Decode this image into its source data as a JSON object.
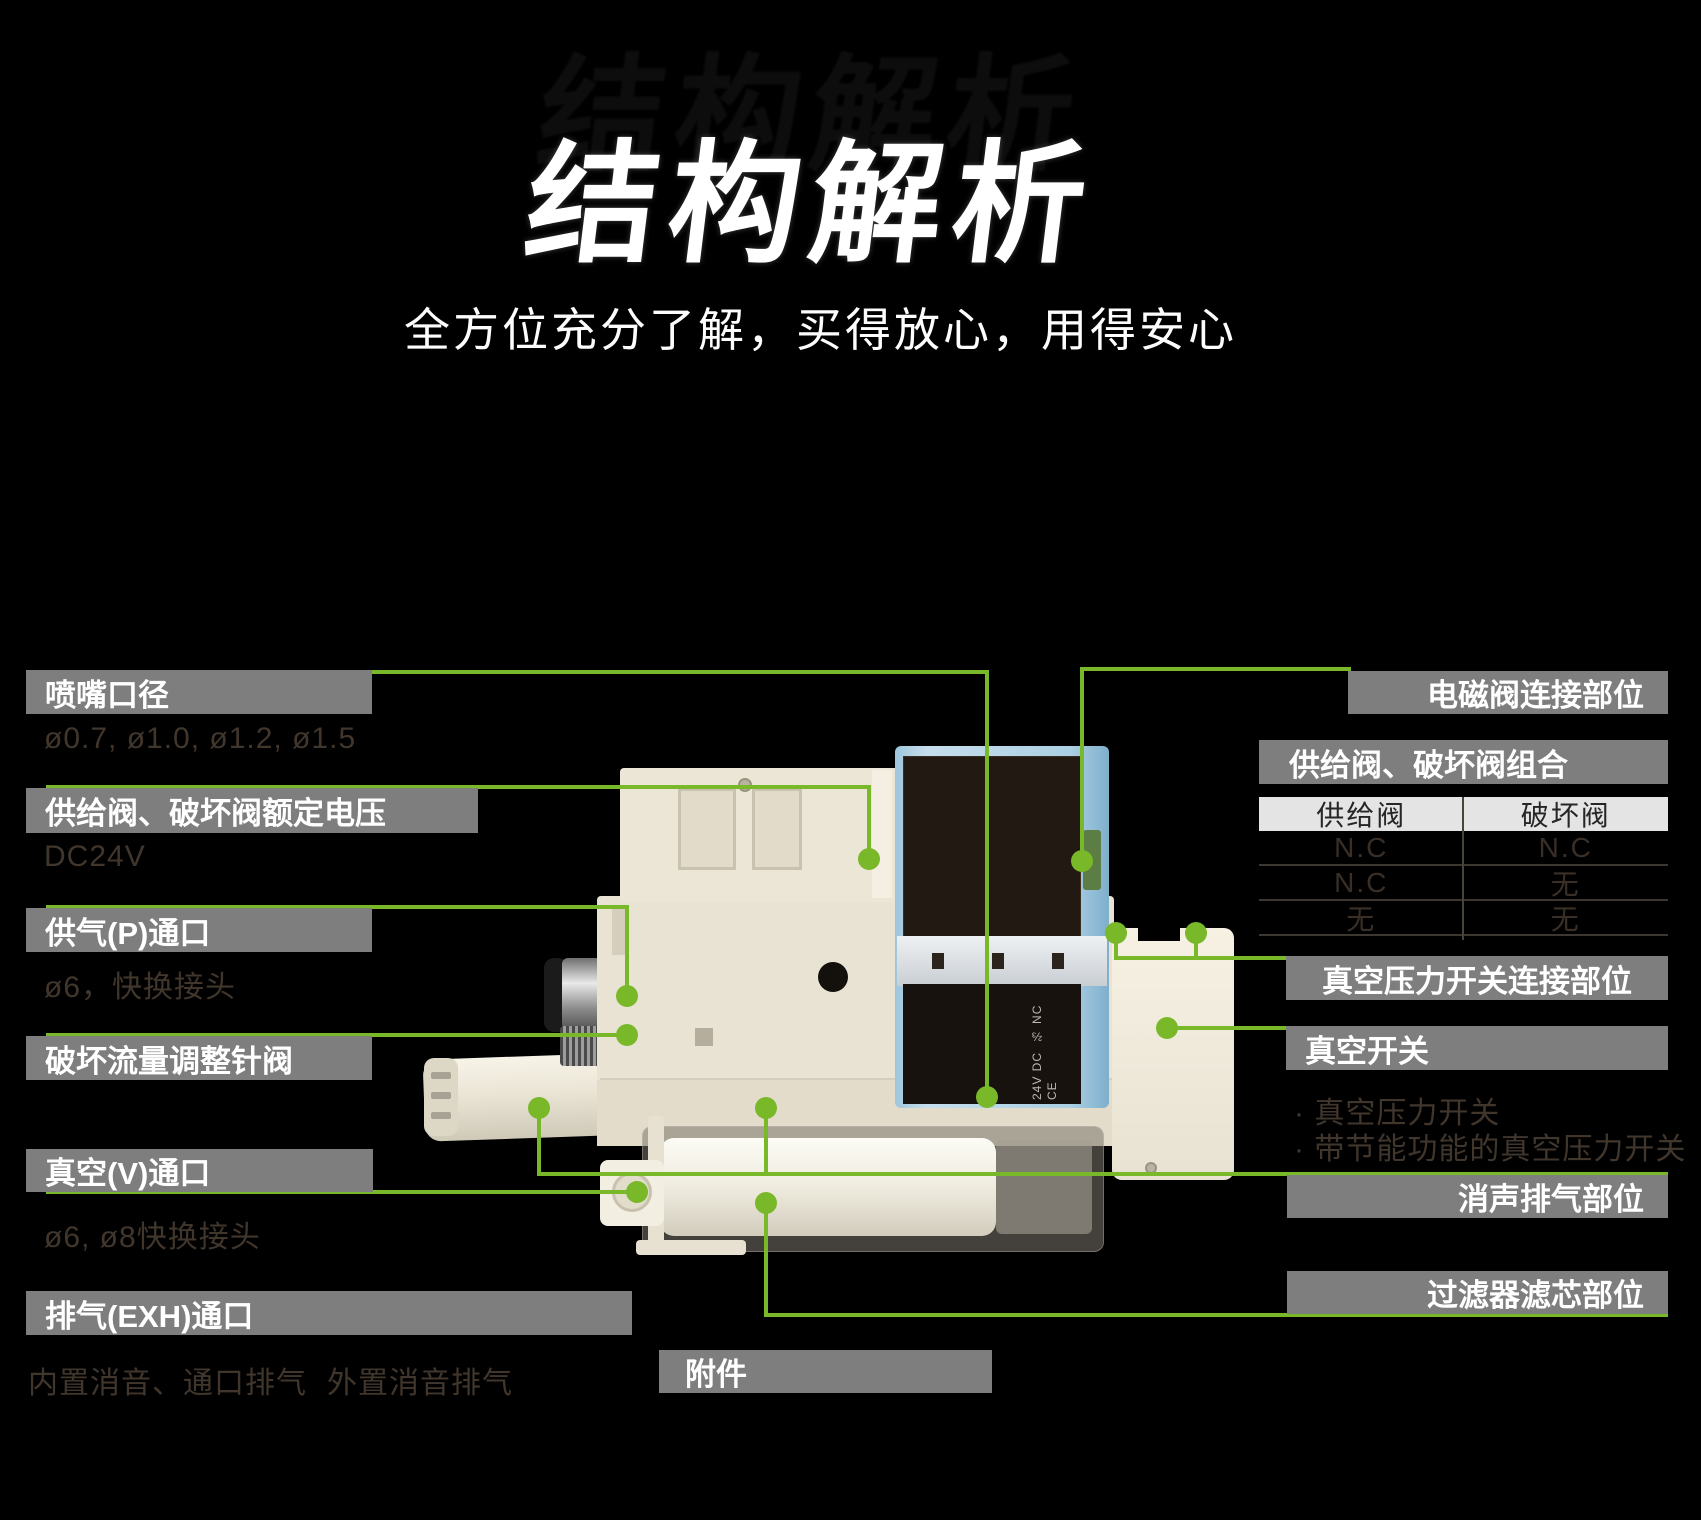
{
  "theme": {
    "background": "#000000",
    "accent_green": "#79b829",
    "label_bg": "#7e7e7e",
    "label_text": "#ffffff",
    "dim_text": "#41362c",
    "table_header_bg": "#e4e4e4",
    "table_header_text": "#262626",
    "table_dim_text": "#392f27"
  },
  "header": {
    "title": "结构解析",
    "subtitle": "全方位充分了解，买得放心，用得安心"
  },
  "left_labels": [
    {
      "label": "喷嘴口径",
      "note": "ø0.7, ø1.0, ø1.2, ø1.5"
    },
    {
      "label": "供给阀、破坏阀额定电压",
      "note": "DC24V"
    },
    {
      "label": "供气(P)通口",
      "note": "ø6，快换接头"
    },
    {
      "label": "破坏流量调整针阀"
    },
    {
      "label": "真空(V)通口",
      "note": "ø6, ø8快换接头"
    },
    {
      "label": "排气(EXH)通口",
      "note": "内置消音、通口排气",
      "note2": "外置消音排气"
    },
    {
      "label": "附件"
    }
  ],
  "right_labels": [
    {
      "label": "电磁阀连接部位"
    },
    {
      "label": "供给阀、破坏阀组合"
    },
    {
      "label": "真空压力开关连接部位"
    },
    {
      "label": "真空开关",
      "bullets": [
        "· 真空压力开关",
        "· 带节能功能的真空压力开关"
      ]
    },
    {
      "label": "消声排气部位"
    },
    {
      "label": "过滤器滤芯部位"
    }
  ],
  "combo_table": {
    "headers": [
      "供给阀",
      "破坏阀"
    ],
    "rows": [
      [
        "N.C",
        "N.C"
      ],
      [
        "N.C",
        "无"
      ],
      [
        "无",
        "无"
      ]
    ]
  },
  "product": {
    "marking_lines": [
      "24V DC",
      "⅔ NC",
      "CE"
    ]
  }
}
